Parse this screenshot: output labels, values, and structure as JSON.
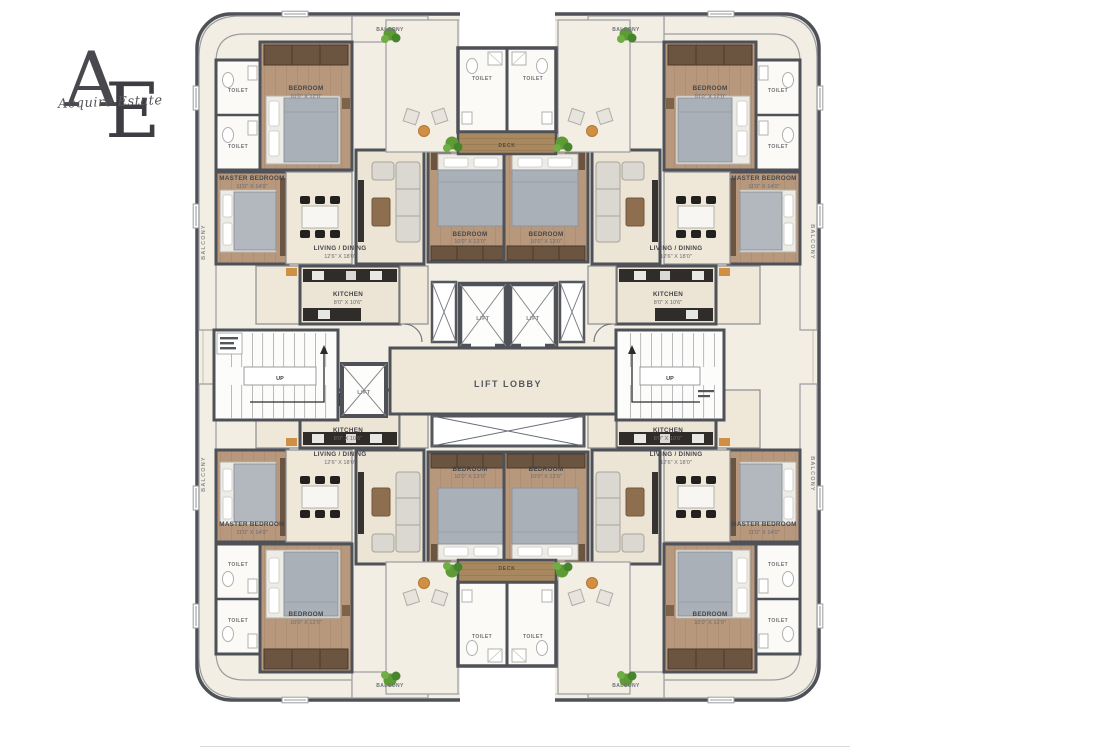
{
  "logo": {
    "letter_a": "A",
    "letter_e": "E",
    "script": "Acquire Estate"
  },
  "plan": {
    "core": {
      "lift_lobby_label": "LIFT LOBBY",
      "lift_label": "LIFT",
      "deck_label": "DECK",
      "toilet_label": "TOILET",
      "stairs_up_label": "UP"
    },
    "rooms": {
      "bedroom": {
        "name": "BEDROOM",
        "dim": "10'0\" X 12'0\""
      },
      "master_bedroom": {
        "name": "MASTER BEDROOM",
        "dim": "11'0\" X 14'0\""
      },
      "living_dining": {
        "name": "LIVING / DINING",
        "dim": "12'6\" X 18'0\""
      },
      "kitchen": {
        "name": "KITCHEN",
        "dim": "8'0\" X 10'6\""
      },
      "bedroom2": {
        "name": "BEDROOM",
        "dim": "10'0\" X 13'0\""
      },
      "toilet": {
        "name": "TOILET"
      },
      "balcony": {
        "name": "BALCONY"
      }
    },
    "colors": {
      "wall": "#4e5157",
      "floor": "#ece4d4",
      "balcony_floor": "#f3eee3",
      "wood_floor": "#b7987c",
      "deck_wood": "#a8885f",
      "kitchen_counter": "#2f2c29",
      "accent_orange": "#cf8f45",
      "plant_green": "#5e9b37"
    }
  }
}
